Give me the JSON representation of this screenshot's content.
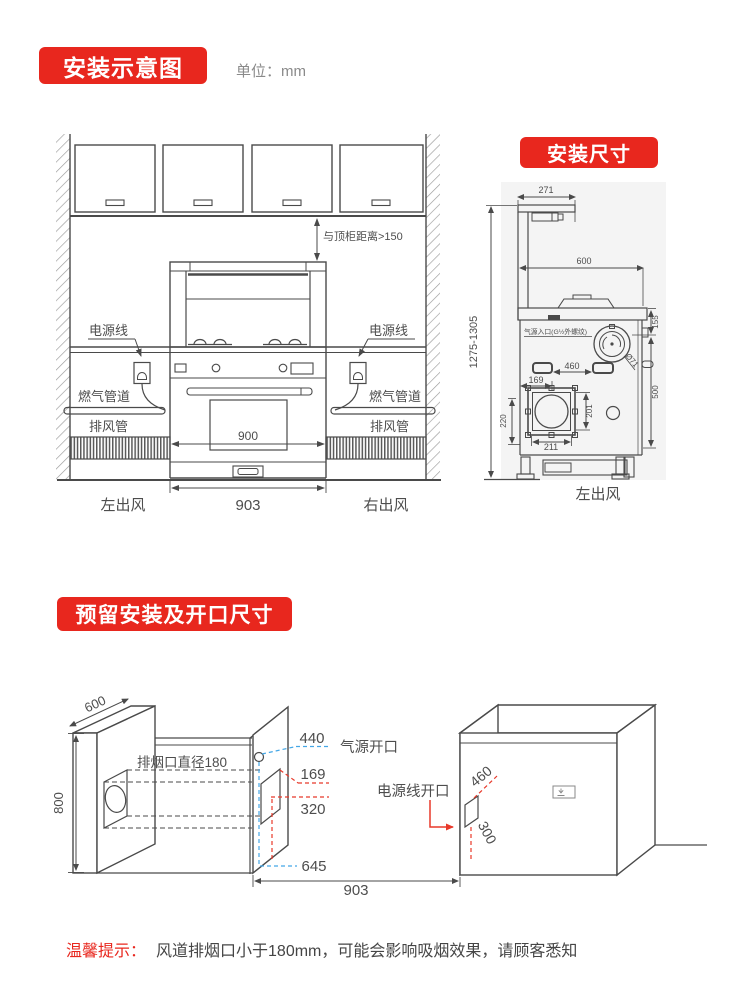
{
  "header": {
    "title": "安装示意图",
    "unit": "单位：mm"
  },
  "front": {
    "gap": "与顶柜距离>150",
    "power_left": "电源线",
    "power_right": "电源线",
    "gas_left": "燃气管道",
    "gas_right": "燃气管道",
    "duct_left": "排风管",
    "duct_right": "排风管",
    "w900": "900",
    "w903": "903",
    "out_left": "左出风",
    "out_right": "右出风"
  },
  "side": {
    "title": "安装尺寸",
    "d271": "271",
    "d600": "600",
    "height": "1275-1305",
    "gas_inlet": "气源入口(G½外螺纹)",
    "d155": "155",
    "d460": "460",
    "d169": "169",
    "d500": "500",
    "d201": "201",
    "d211": "211",
    "d220": "220",
    "dia71": "Ø71",
    "out": "左出风"
  },
  "opening": {
    "title": "预留安装及开口尺寸",
    "d600": "600",
    "d800": "800",
    "smoke": "排烟口直径180",
    "d440": "440",
    "gas_label": "气源开口",
    "d169": "169",
    "d320": "320",
    "d645": "645",
    "power_label": "电源线开口",
    "d460": "460",
    "d300": "300",
    "d903": "903"
  },
  "tip": {
    "label": "温馨提示：",
    "text": "风道排烟口小于180mm，可能会影响吸烟效果，请顾客悉知"
  },
  "colors": {
    "banner_red": "#e8271e",
    "dim_red": "#e8392a",
    "dim_blue": "#45a7e6",
    "line_dark": "#4a4a4a"
  }
}
